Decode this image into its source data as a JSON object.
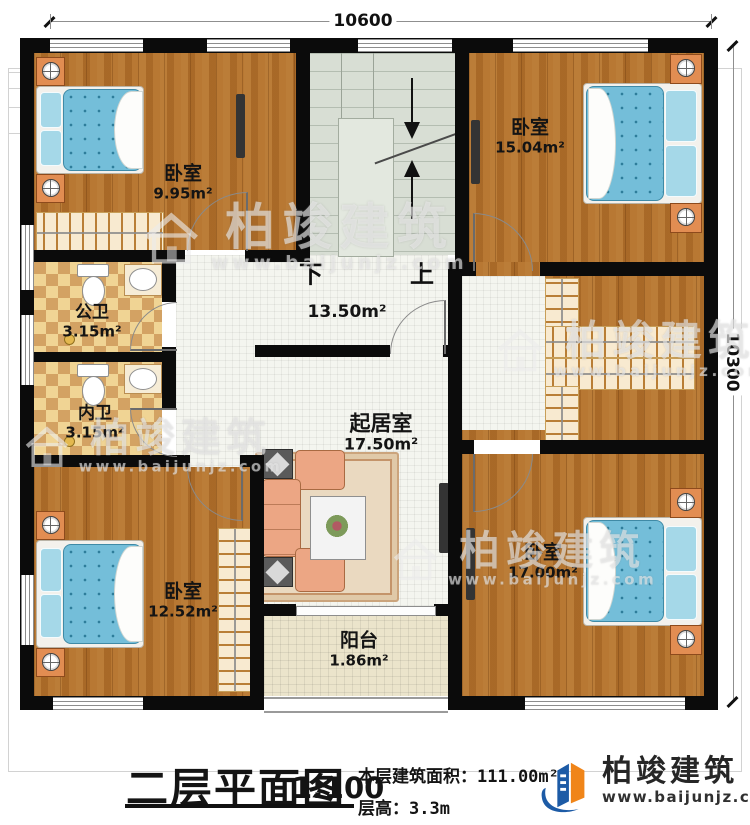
{
  "plan": {
    "dimensions": {
      "width_mm": "10600",
      "height_mm": "10300"
    },
    "stairs": {
      "down": "下",
      "up": "上"
    },
    "rooms": {
      "bedroom_top_left": {
        "name": "卧室",
        "area": "9.95m²"
      },
      "bedroom_top_right": {
        "name": "卧室",
        "area": "15.04m²"
      },
      "public_bathroom": {
        "name": "公卫",
        "area": "3.15m²"
      },
      "private_bathroom": {
        "name": "内卫",
        "area": "3.15m²"
      },
      "hall": {
        "area": "13.50m²"
      },
      "living_room": {
        "name": "起居室",
        "area": "17.50m²"
      },
      "bedroom_bottom_left": {
        "name": "卧室",
        "area": "12.52m²"
      },
      "bedroom_bottom_right": {
        "name": "卧室",
        "area": "17.00m²"
      },
      "balcony": {
        "name": "阳台",
        "area": "1.86m²"
      }
    }
  },
  "title_block": {
    "title": "二层平面图",
    "scale": "1:100",
    "area_label": "本层建筑面积：",
    "area_value": "111.00m²",
    "height_label": "层高：",
    "height_value": "3.3m"
  },
  "brand": {
    "name": "柏竣建筑",
    "website": "www.baijunjz.com"
  },
  "watermark": {
    "name": "柏竣建筑",
    "website": "www.baijunjz.com"
  },
  "colors": {
    "wall": "#0b0b0b",
    "wood": "#b0702c",
    "bed": "#74bed9",
    "stair": "#d8ded4",
    "logo_blue": "#1d5ba6",
    "logo_orange": "#f08519"
  }
}
